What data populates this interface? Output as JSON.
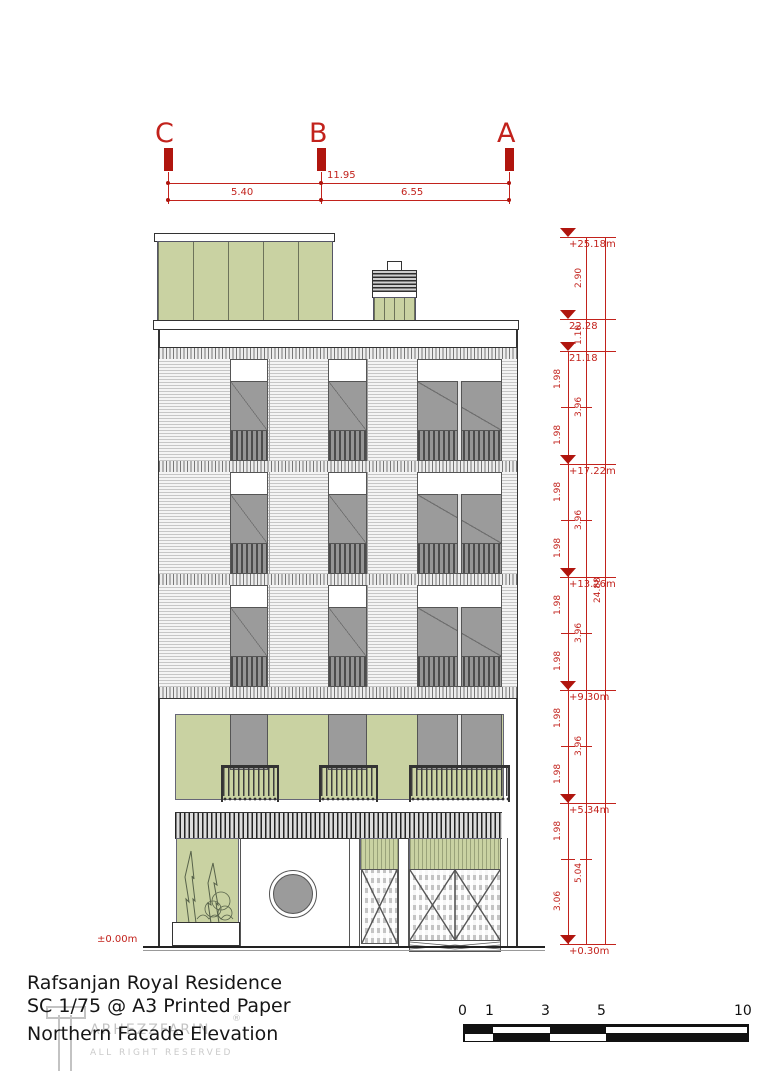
{
  "title_block": {
    "project": "Rafsanjan Royal Residence",
    "scale_note": "SC 1/75 @ A3 Printed Paper",
    "drawing_name": "Northern Facade Elevation"
  },
  "watermark": {
    "brand": "ARHEZZFARIN",
    "registered": "®",
    "rights": "ALL RIGHT RESERVED"
  },
  "grid": {
    "markers": [
      {
        "label": "C"
      },
      {
        "label": "B"
      },
      {
        "label": "A"
      }
    ],
    "dimensions": {
      "total": "11.95",
      "span_cb": "5.40",
      "span_ba": "6.55"
    }
  },
  "levels": [
    {
      "label": "+25.18m"
    },
    {
      "label": "22.28"
    },
    {
      "label": "21.18"
    },
    {
      "label": "+17.22m"
    },
    {
      "label": "+13.26m"
    },
    {
      "label": "+9.30m"
    },
    {
      "label": "+5.34m"
    },
    {
      "label": "+0.30m"
    }
  ],
  "ground_level_label": "±0.00m",
  "vertical_dims": {
    "overall": "24.88",
    "story": [
      {
        "label": "2.90"
      },
      {
        "label": "1.10"
      },
      {
        "label": "3.96"
      },
      {
        "label": "3.96"
      },
      {
        "label": "3.96"
      },
      {
        "label": "3.96"
      },
      {
        "label": "5.04"
      }
    ],
    "sub": [
      {
        "label": "1.98"
      },
      {
        "label": "1.98"
      },
      {
        "label": "1.98"
      },
      {
        "label": "1.98"
      },
      {
        "label": "1.98"
      },
      {
        "label": "1.98"
      },
      {
        "label": "1.98"
      },
      {
        "label": "1.98"
      },
      {
        "label": "1.98"
      },
      {
        "label": "3.06"
      }
    ]
  },
  "scale_bar": {
    "ticks": [
      {
        "label": "0"
      },
      {
        "label": "1"
      },
      {
        "label": "3"
      },
      {
        "label": "5"
      },
      {
        "label": "10"
      }
    ]
  },
  "colors": {
    "annotation_red": "#c2221c",
    "facade_green": "#c9d2a2",
    "glazing_gray": "#9b9b9b"
  }
}
